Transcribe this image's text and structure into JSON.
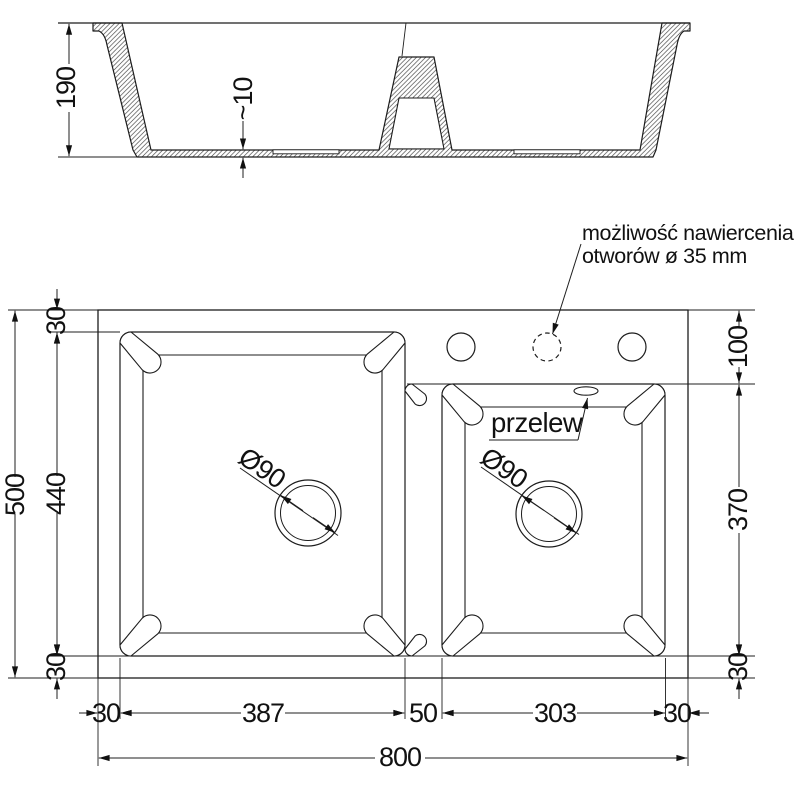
{
  "section": {
    "depth": "190",
    "floor_thickness": "~10"
  },
  "plan": {
    "overall_width": "800",
    "overall_height": "500",
    "left": {
      "top_margin": "30",
      "bowl_height": "440",
      "bottom_margin": "30"
    },
    "right": {
      "deck_height": "100",
      "bowl_height": "370",
      "bottom_margin": "30"
    },
    "bottom": {
      "left_margin": "30",
      "left_bowl_width": "387",
      "divider_width": "50",
      "right_bowl_width": "303",
      "right_margin": "30"
    },
    "left_drain": "Ø90",
    "right_drain": "Ø90",
    "overflow_label": "przelew",
    "note_line1": "możliwość nawiercenia",
    "note_line2": "otworów ø 35 mm"
  },
  "colors": {
    "line": "#1c1c1c",
    "background": "#ffffff"
  }
}
